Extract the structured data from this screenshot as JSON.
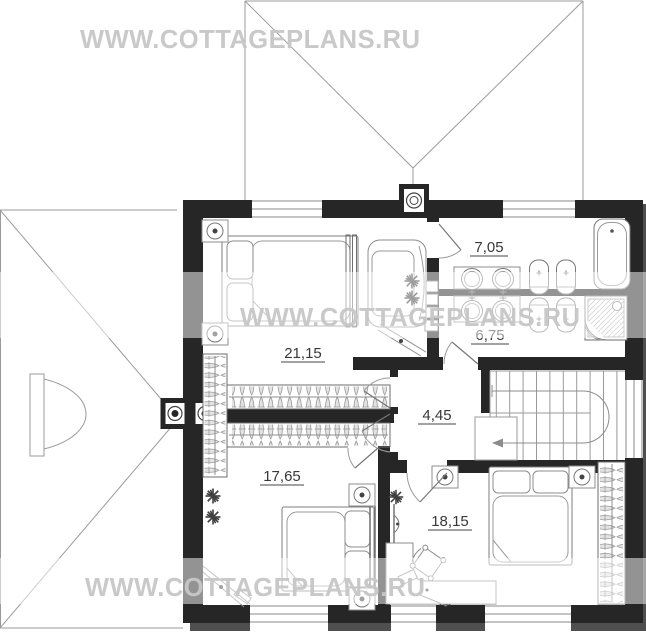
{
  "watermark": {
    "text": "WWW.COTTAGEPLANS.RU"
  },
  "rooms": [
    {
      "name": "bathroom-upper",
      "area": "7,05"
    },
    {
      "name": "bathroom-lower",
      "area": "6,75"
    },
    {
      "name": "bedroom-master",
      "area": "21,15"
    },
    {
      "name": "hall",
      "area": "4,45"
    },
    {
      "name": "bedroom-left",
      "area": "17,65"
    },
    {
      "name": "bedroom-right",
      "area": "18,15"
    }
  ],
  "colors": {
    "wall": "#262626",
    "furniture_line": "#8c8c8c",
    "roof_line": "#9b9b9b",
    "label_text": "#383838",
    "watermark_text": "#c6c6c6",
    "shadow": "#4f4f4f"
  }
}
